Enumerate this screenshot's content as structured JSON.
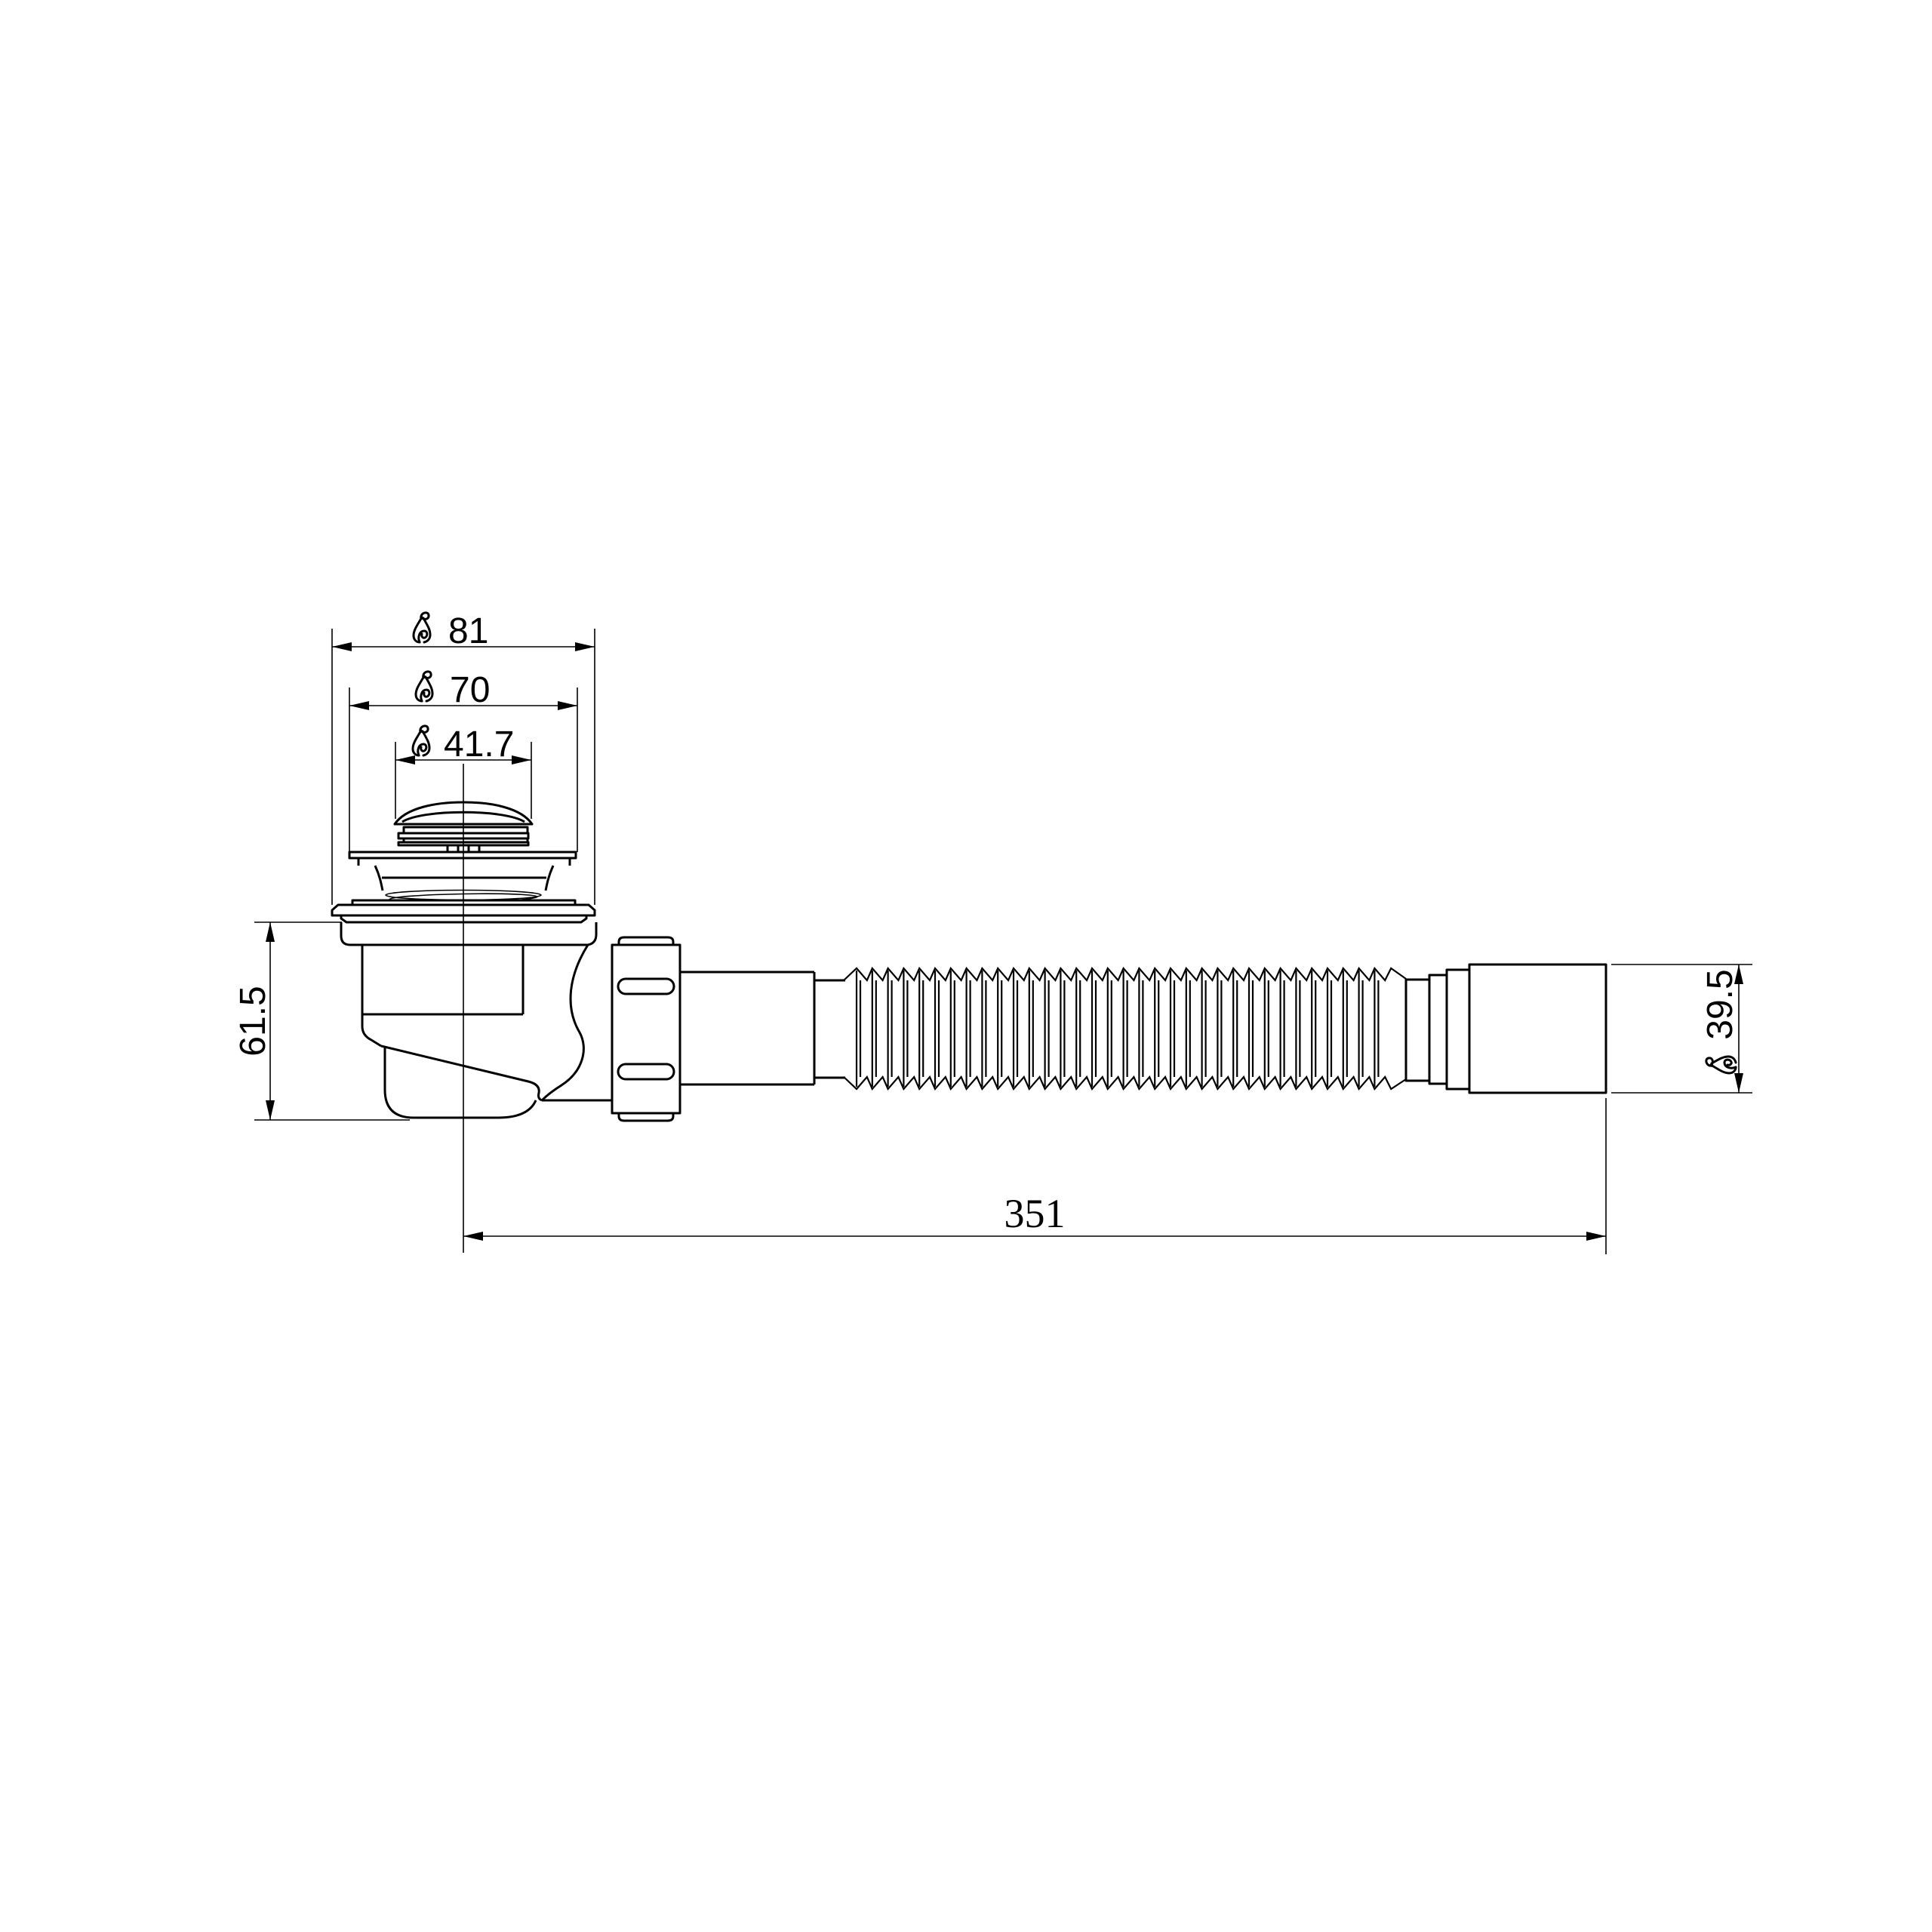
{
  "drawing": {
    "background_color": "#ffffff",
    "line_color": "#000000",
    "view": "side elevation, pop-up drain waste with flexible outlet hose",
    "diameter_symbol": "∅",
    "dimensions": {
      "cap_outer": {
        "prefix": "∅",
        "value": "81"
      },
      "flange": {
        "prefix": "∅",
        "value": "70"
      },
      "cap_top": {
        "prefix": "∅",
        "value": "41.7"
      },
      "body_height": {
        "prefix": "",
        "value": "61.5"
      },
      "outlet_end": {
        "prefix": "∅",
        "value": "39.5"
      },
      "overall_length": {
        "prefix": "",
        "value": "351"
      }
    }
  }
}
